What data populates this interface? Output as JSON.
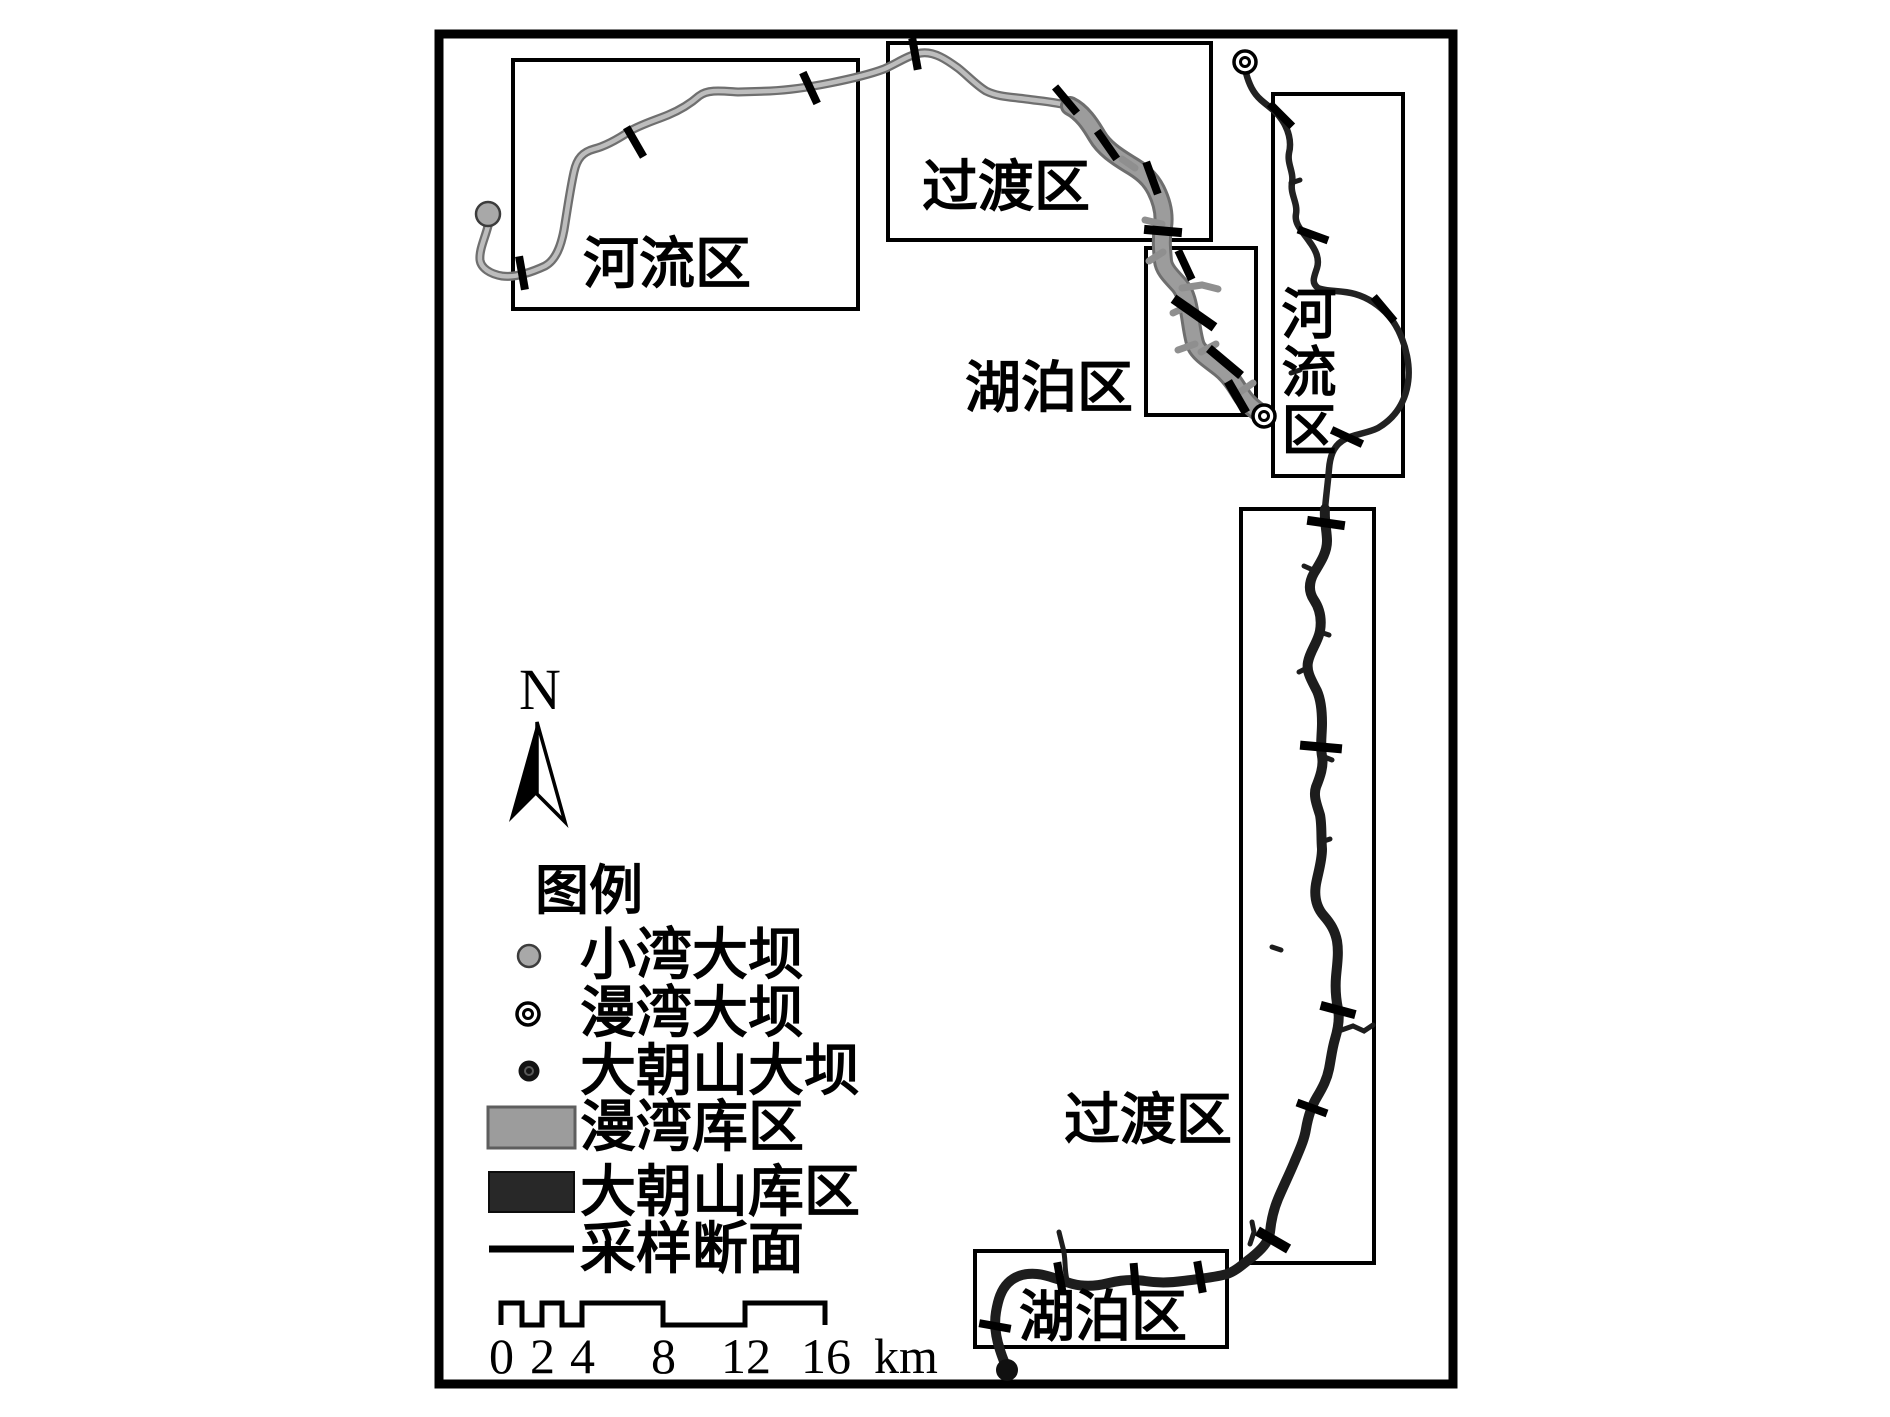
{
  "map": {
    "north_label": "N",
    "zones": {
      "manwan": {
        "river": "河流区",
        "transition": "过渡区",
        "lake": "湖泊区"
      },
      "dachaoshan": {
        "river": "河流区",
        "transition": "过渡区",
        "lake": "湖泊区"
      }
    },
    "legend": {
      "title": "图例",
      "items": [
        {
          "symbol": "xiaowan-dam-gray-circle",
          "label": "小湾大坝"
        },
        {
          "symbol": "manwan-dam-double-circle",
          "label": "漫湾大坝"
        },
        {
          "symbol": "dachaoshan-dam-black-dot",
          "label": "大朝山大坝"
        },
        {
          "symbol": "manwan-reservoir-gray-swatch",
          "label": "漫湾库区"
        },
        {
          "symbol": "dachaoshan-reservoir-dark-swatch",
          "label": "大朝山库区"
        },
        {
          "symbol": "sampling-section-line",
          "label": "采样断面"
        }
      ]
    },
    "scale_bar": {
      "labels": [
        "0",
        "2",
        "4",
        "8",
        "12",
        "16"
      ],
      "unit": "km",
      "segment_boundaries_km": [
        0,
        1,
        2,
        3,
        4,
        8,
        12,
        16
      ]
    },
    "colors": {
      "manwan_reservoir_gray": "#9c9c9c",
      "dachaoshan_reservoir_dark": "#1d1d1d",
      "outline_black": "#000000",
      "background": "#ffffff"
    }
  }
}
